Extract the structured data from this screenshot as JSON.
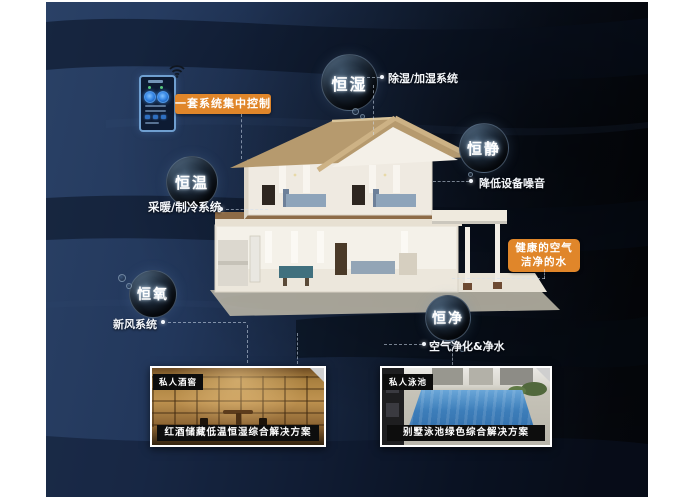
{
  "colors": {
    "accent_orange": "#e0862a",
    "background_navy": "#22375b",
    "background_dark": "#04060a",
    "bubble_text": "#ffffff"
  },
  "device": {
    "label": "smart-home-controller-phone",
    "wifi_icon": "wifi-icon"
  },
  "callouts": {
    "control_label": "一套系统集中控制",
    "healthy": {
      "line1": "健康的空气",
      "line2": "洁净的水"
    }
  },
  "bubbles": [
    {
      "label": "恒湿",
      "desc": "除湿/加湿系统"
    },
    {
      "label": "恒静",
      "desc": "降低设备噪音"
    },
    {
      "label": "恒温",
      "desc": "采暖/制冷系统"
    },
    {
      "label": "恒氧",
      "desc": "新风系统"
    },
    {
      "label": "恒净",
      "desc": "空气净化&净水"
    }
  ],
  "photo_cards": [
    {
      "tag": "私人酒窖",
      "caption": "红酒储藏低温恒湿综合解决方案"
    },
    {
      "tag": "私人泳池",
      "caption": "别墅泳池绿色综合解决方案"
    }
  ]
}
